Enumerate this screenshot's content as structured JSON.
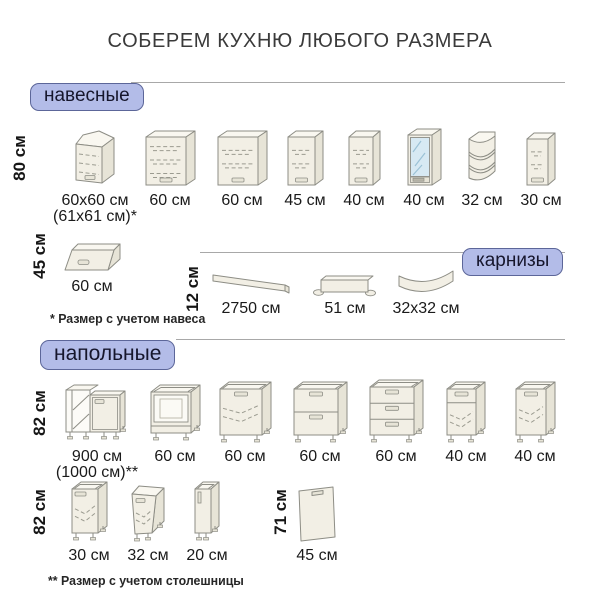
{
  "title": "СОБЕРЕМ КУХНЮ ЛЮБОГО РАЗМЕРА",
  "sections": {
    "wall": {
      "badge": "навесные",
      "row1": {
        "height_label": "80 см",
        "items": [
          {
            "label": "60x60 см",
            "label2": "(61x61 см)*",
            "icon": "corner-wall-cabinet"
          },
          {
            "label": "60 см",
            "icon": "wall-cabinet-60-3shelf"
          },
          {
            "label": "60 см",
            "icon": "wall-cabinet-60-2shelf"
          },
          {
            "label": "45 см",
            "icon": "wall-cabinet-45"
          },
          {
            "label": "40 см",
            "icon": "wall-cabinet-40"
          },
          {
            "label": "40 см",
            "icon": "glass-door-wall-cabinet"
          },
          {
            "label": "32 см",
            "icon": "open-corner-shelf"
          },
          {
            "label": "30 см",
            "icon": "wall-cabinet-30"
          }
        ]
      },
      "row2": {
        "height_label": "45 см",
        "items": [
          {
            "label": "60 см",
            "icon": "liftup-wall-cabinet"
          }
        ]
      },
      "footnote": "* Размер с учетом навеса"
    },
    "cornices": {
      "badge": "карнизы",
      "height_label": "12 см",
      "items": [
        {
          "label": "2750 см",
          "icon": "cornice-long"
        },
        {
          "label": "51 см",
          "icon": "cornice-straight"
        },
        {
          "label": "32x32 см",
          "icon": "cornice-curved"
        }
      ]
    },
    "floor": {
      "badge": "напольные",
      "row1": {
        "height_label": "82 см",
        "items": [
          {
            "label": "900 см",
            "label2": "(1000 см)**",
            "icon": "corner-sink-base-cabinet"
          },
          {
            "label": "60 см",
            "icon": "oven-base-cabinet"
          },
          {
            "label": "60 см",
            "icon": "door-base-cabinet-60"
          },
          {
            "label": "60 см",
            "icon": "two-drawer-base-cabinet"
          },
          {
            "label": "60 см",
            "icon": "three-drawer-base-cabinet"
          },
          {
            "label": "40 см",
            "icon": "drawer-door-base-cabinet-40"
          },
          {
            "label": "40 см",
            "icon": "door-base-cabinet-40"
          }
        ]
      },
      "row2": {
        "height_label": "82 см",
        "items": [
          {
            "label": "30 см",
            "icon": "door-base-cabinet-30"
          },
          {
            "label": "32 см",
            "icon": "angled-end-base-cabinet-32"
          },
          {
            "label": "20 см",
            "icon": "slim-base-cabinet-20"
          }
        ]
      },
      "panel_row": {
        "height_label": "71 см",
        "items": [
          {
            "label": "45 см",
            "icon": "door-panel-45"
          }
        ]
      },
      "footnote": "** Размер с учетом столешницы"
    }
  },
  "colors": {
    "badge_bg": "#b3bce8",
    "badge_border": "#5c6699",
    "divider_line": "#a8a8a8",
    "cabinet_fill": "#f2efe5",
    "cabinet_top": "#f9f7f0",
    "cabinet_side": "#e7e4d7",
    "cabinet_stroke": "#8d8d85",
    "glass": "#d7e9f3",
    "text": "#1a1a1a"
  }
}
